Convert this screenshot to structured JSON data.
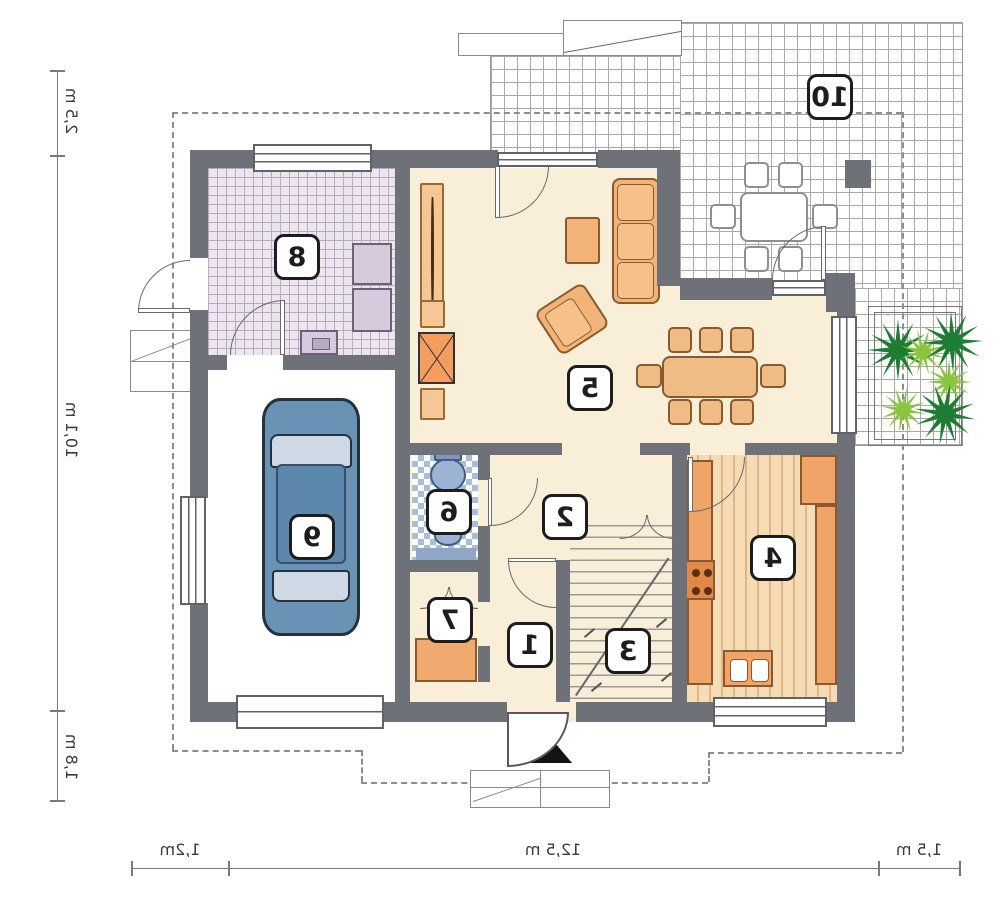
{
  "plan": {
    "type": "residential-floor-plan",
    "mirrored_text": true,
    "room_labels": [
      "1",
      "2",
      "3",
      "4",
      "5",
      "6",
      "7",
      "8",
      "9",
      "10"
    ],
    "dimensions_left": [
      "2,5 m",
      "10,1 m",
      "1,8 m"
    ],
    "dimensions_bottom": [
      "1,2m",
      "12,5 m",
      "1,5 m"
    ],
    "icons": {
      "entrance": "entrance-arrow-icon",
      "plant": "plant-icon",
      "car": "car-top-view-icon"
    },
    "colors": {
      "wall": "#6e7278",
      "floor_cream": "#f9eed8",
      "furniture_orange": "#f2b378",
      "counter_orange": "#f0a468",
      "kitchen_stripe": "#dfb687",
      "car_blue": "#6a92b5",
      "car_window": "#cfd9e6",
      "bath_tile_blue": "#a9bcd9",
      "laundry_lavender": "#d6cbdc",
      "plant_dark_green": "#1e7d33",
      "plant_light_green": "#8bc53f",
      "terrace_grid": "#a9a9a9",
      "roof_outline_dash": "#8d8d8d",
      "label_border": "#1d1d1d"
    }
  }
}
